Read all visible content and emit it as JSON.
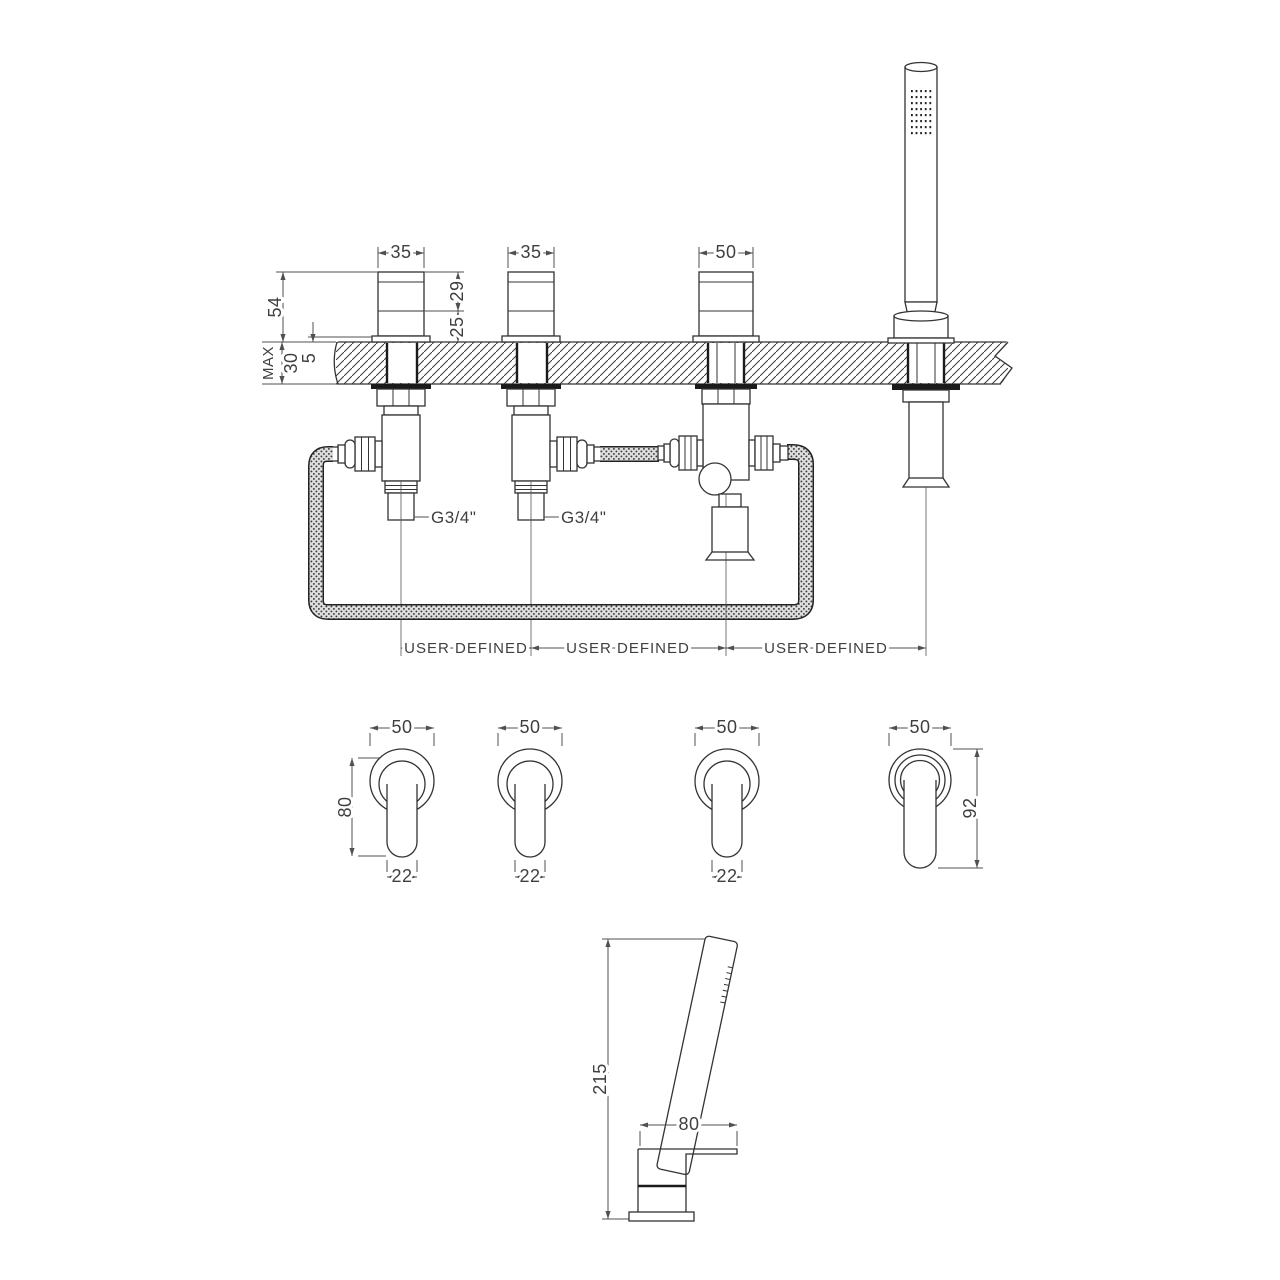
{
  "drawing": {
    "type": "bath-shower-mixer-installation-diagram",
    "colors": {
      "line": "#333333",
      "dim_text": "#3f3f3f",
      "background": "#ffffff"
    },
    "top_view": {
      "width_labels": [
        "35",
        "35",
        "50"
      ],
      "total_height": "54",
      "upper_section": "29",
      "lower_section": "25",
      "deck_max": "MAX",
      "deck_thickness": "30",
      "flange_height": "5",
      "thread_labels": [
        "G3/4\"",
        "G3/4\""
      ],
      "spacing_labels": [
        "USER DEFINED",
        "USER DEFINED",
        "USER DEFINED"
      ]
    },
    "handles_view": {
      "width_labels": [
        "50",
        "50",
        "50",
        "50"
      ],
      "handle_height": "80",
      "lever_widths": [
        "22",
        "22",
        "22"
      ],
      "holder_height": "92"
    },
    "handset_view": {
      "total_height": "215",
      "holder_width": "80"
    }
  }
}
